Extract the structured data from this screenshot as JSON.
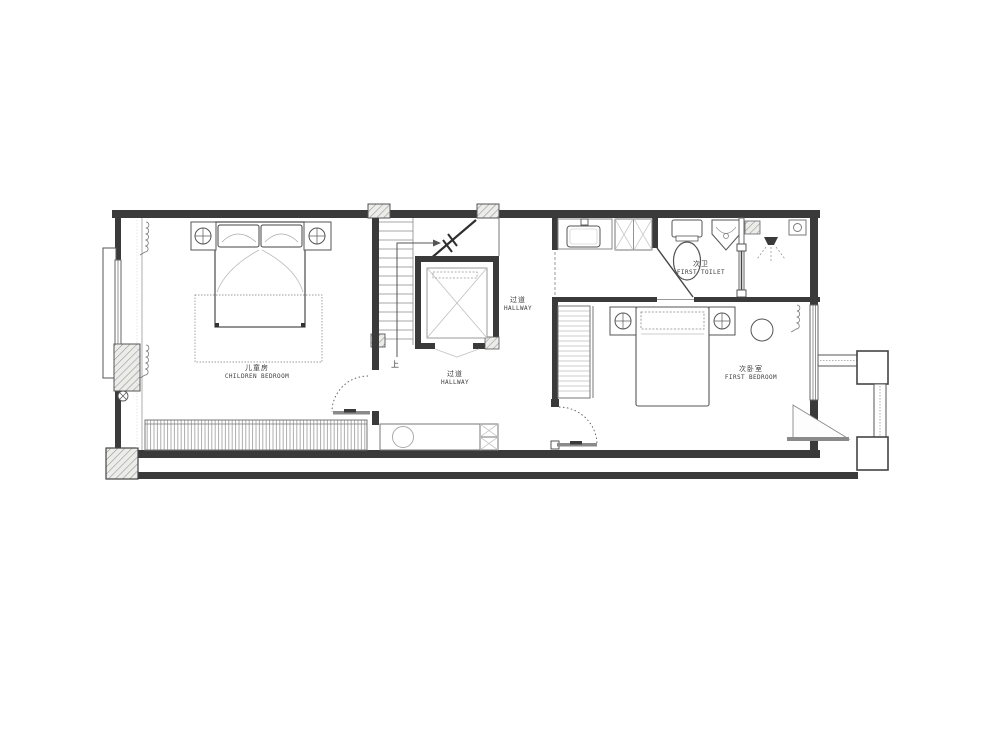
{
  "rooms": {
    "children_bedroom": {
      "name_zh": "儿童房",
      "name_en": "CHILDREN BEDROOM"
    },
    "hallway_main": {
      "name_zh": "过道",
      "name_en": "HALLWAY"
    },
    "hallway_upper": {
      "name_zh": "过道",
      "name_en": "HALLWAY"
    },
    "first_toilet": {
      "name_zh": "次卫",
      "name_en": "FIRST TOILET"
    },
    "first_bedroom": {
      "name_zh": "次卧室",
      "name_en": "FIRST BEDROOM"
    }
  },
  "annotations": {
    "stair_direction_label": "上"
  },
  "colors": {
    "background": "#ffffff",
    "wall": "#3a3a3a",
    "furniture_line": "#555555",
    "light_line": "#aaaaaa",
    "hatch_line": "#8f8f8a"
  }
}
